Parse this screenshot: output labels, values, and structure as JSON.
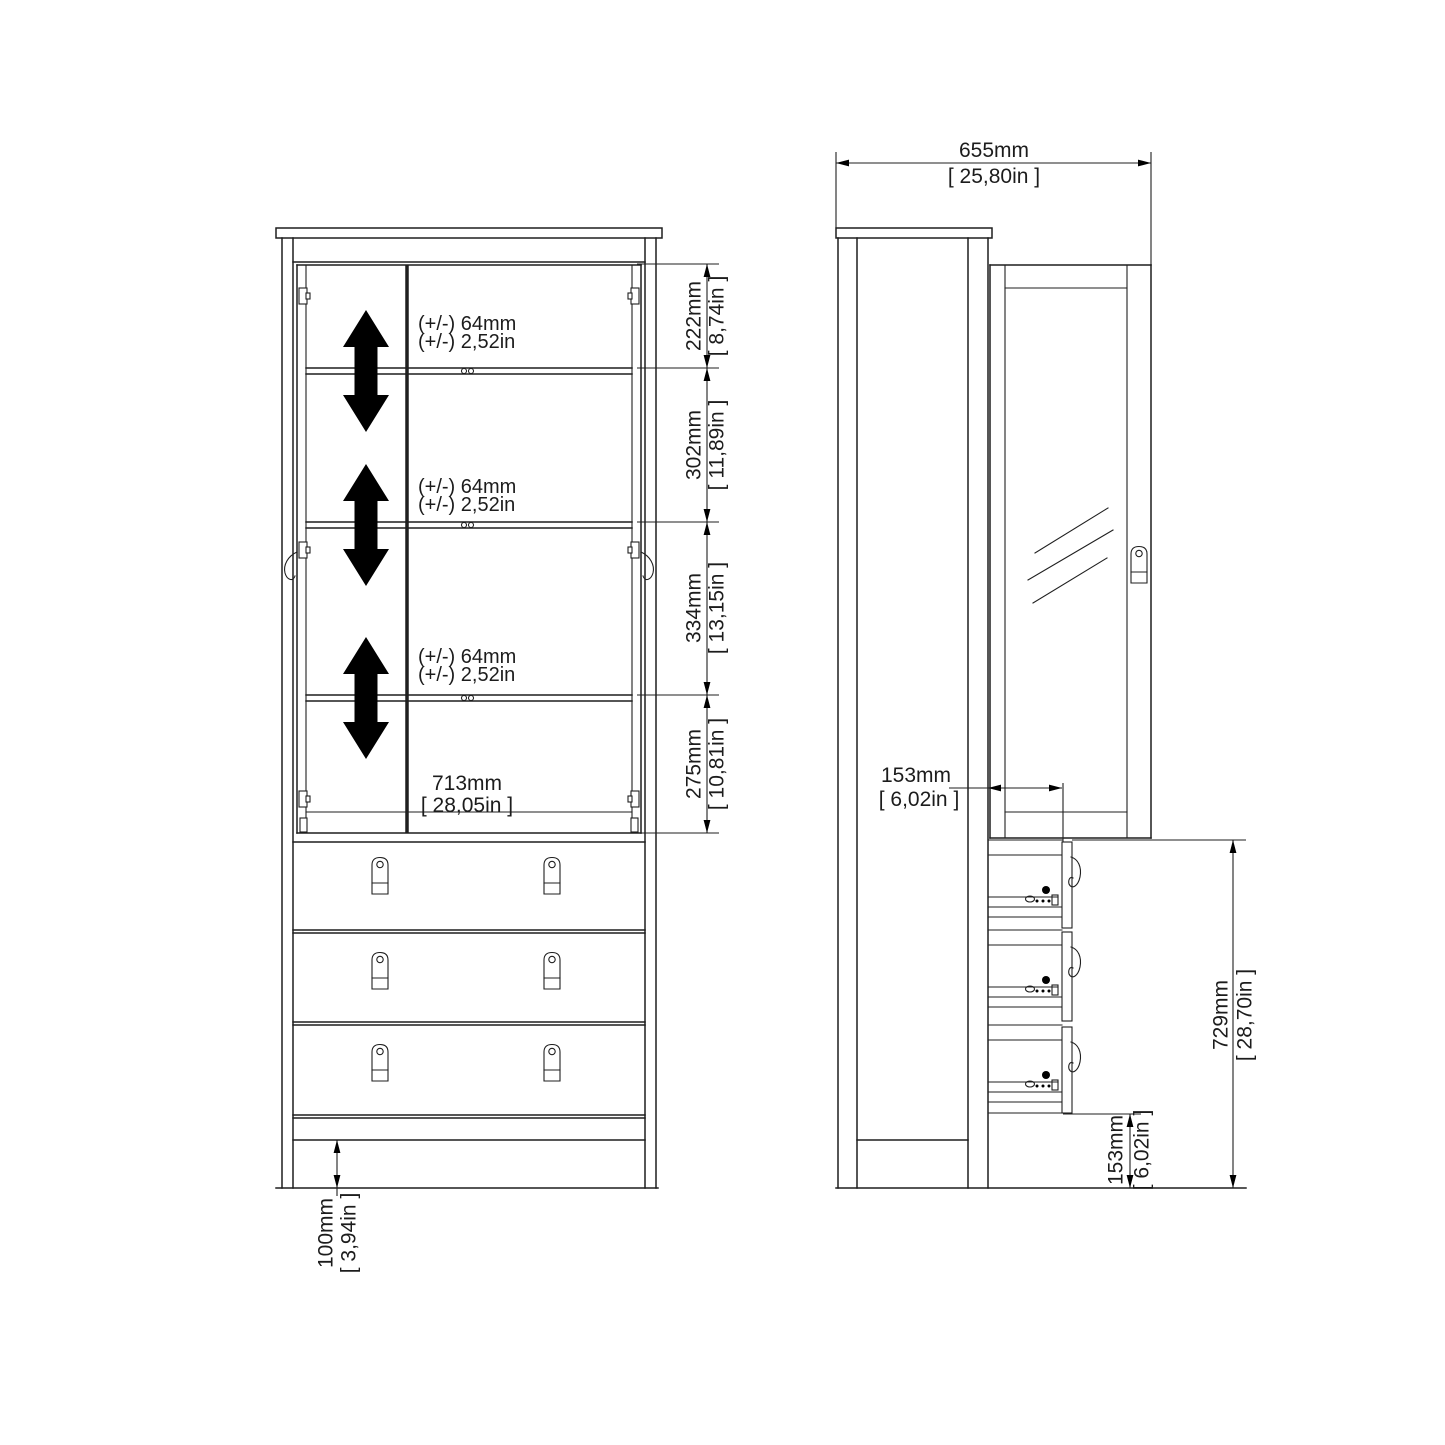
{
  "drawing": {
    "front_view": {
      "shelf_notes": [
        {
          "metric": "(+/-) 64mm",
          "imperial": "(+/-) 2,52in"
        },
        {
          "metric": "(+/-) 64mm",
          "imperial": "(+/-) 2,52in"
        },
        {
          "metric": "(+/-) 64mm",
          "imperial": "(+/-) 2,52in"
        }
      ],
      "interior_width": {
        "metric": "713mm",
        "imperial": "[ 28,05in ]"
      },
      "section_heights": [
        {
          "metric": "222mm",
          "imperial": "[ 8,74in ]"
        },
        {
          "metric": "302mm",
          "imperial": "[ 11,89in ]"
        },
        {
          "metric": "334mm",
          "imperial": "[ 13,15in ]"
        },
        {
          "metric": "275mm",
          "imperial": "[ 10,81in ]"
        }
      ],
      "plinth_height": {
        "metric": "100mm",
        "imperial": "[ 3,94in ]"
      }
    },
    "side_view": {
      "depth": {
        "metric": "655mm",
        "imperial": "[ 25,80in ]"
      },
      "drawer_inset_depth": {
        "metric": "153mm",
        "imperial": "[ 6,02in ]"
      },
      "drawer_stack_height": {
        "metric": "729mm",
        "imperial": "[ 28,70in ]"
      },
      "base_height": {
        "metric": "153mm",
        "imperial": "[ 6,02in ]"
      }
    },
    "colors": {
      "line": "#1f1f1f",
      "arrow_fill": "#000000",
      "background": "#ffffff"
    }
  }
}
